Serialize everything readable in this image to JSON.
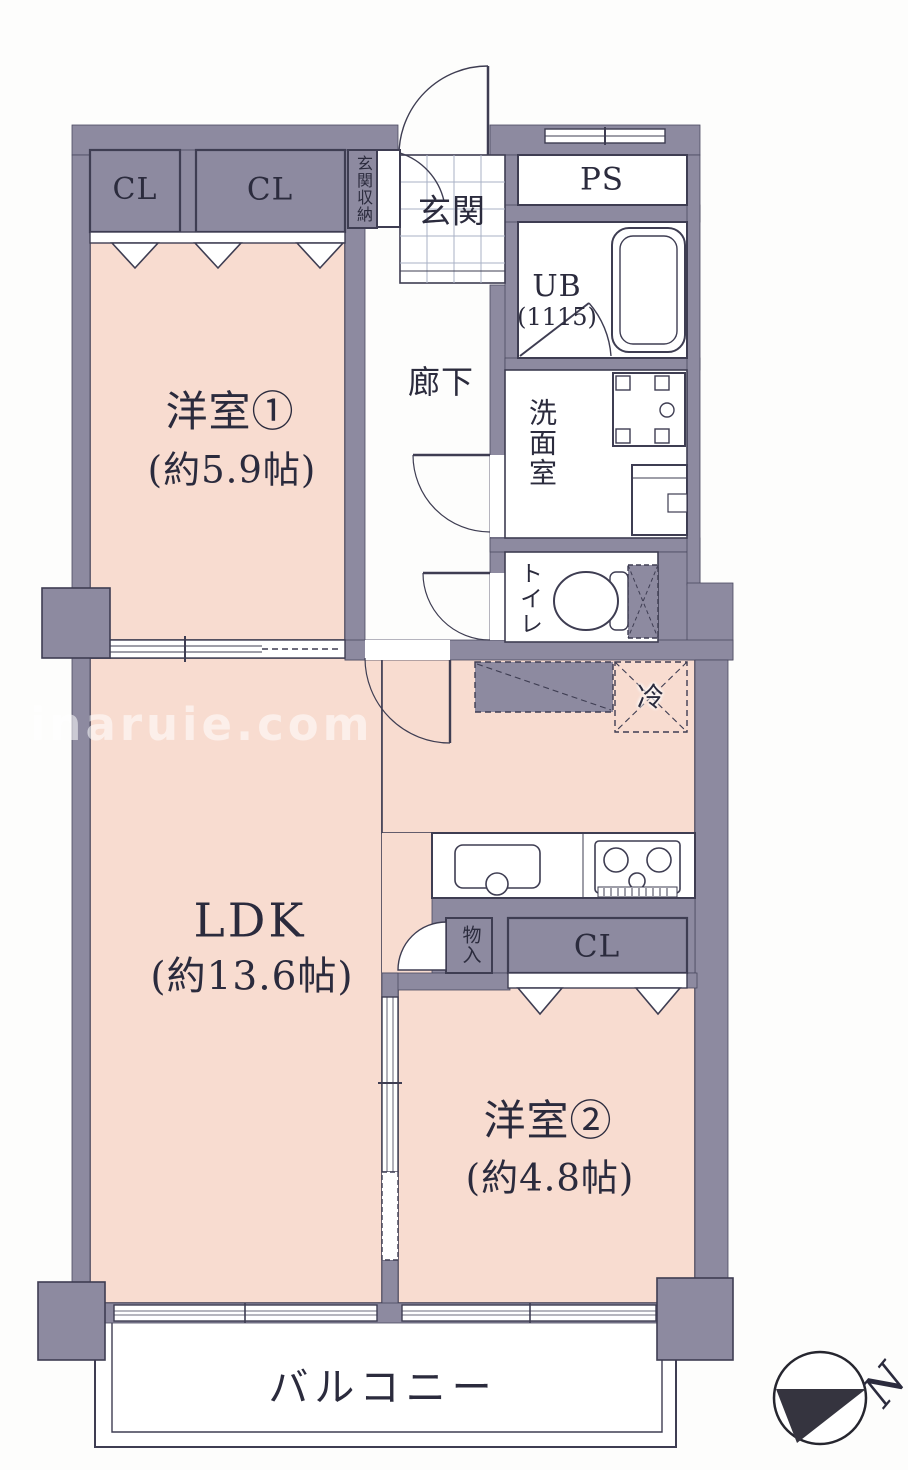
{
  "watermark": "inaruie.com",
  "plan": {
    "rooms": {
      "yoshitsu1": {
        "name": "洋室①",
        "size": "(約5.9帖)"
      },
      "ldk": {
        "name": "LDK",
        "size": "(約13.6帖)"
      },
      "yoshitsu2": {
        "name": "洋室②",
        "size": "(約4.8帖)"
      },
      "genkan": "玄関",
      "rouka": "廊下",
      "senmenshitsu": "洗面室",
      "toilet": "トイレ",
      "ub": {
        "name": "UB",
        "size": "(1115)"
      },
      "ps": "PS",
      "balcony": "バルコニー"
    },
    "storage": {
      "closet1": "CL",
      "closet2": "CL",
      "closet3": "CL",
      "genkan_storage": "玄関収納",
      "monoire": "物入",
      "fridge": "冷"
    },
    "compass": {
      "north": "N"
    },
    "colors": {
      "wall": "#8d8aa0",
      "room": "#f8dcd0",
      "line": "#3e3d52"
    }
  }
}
